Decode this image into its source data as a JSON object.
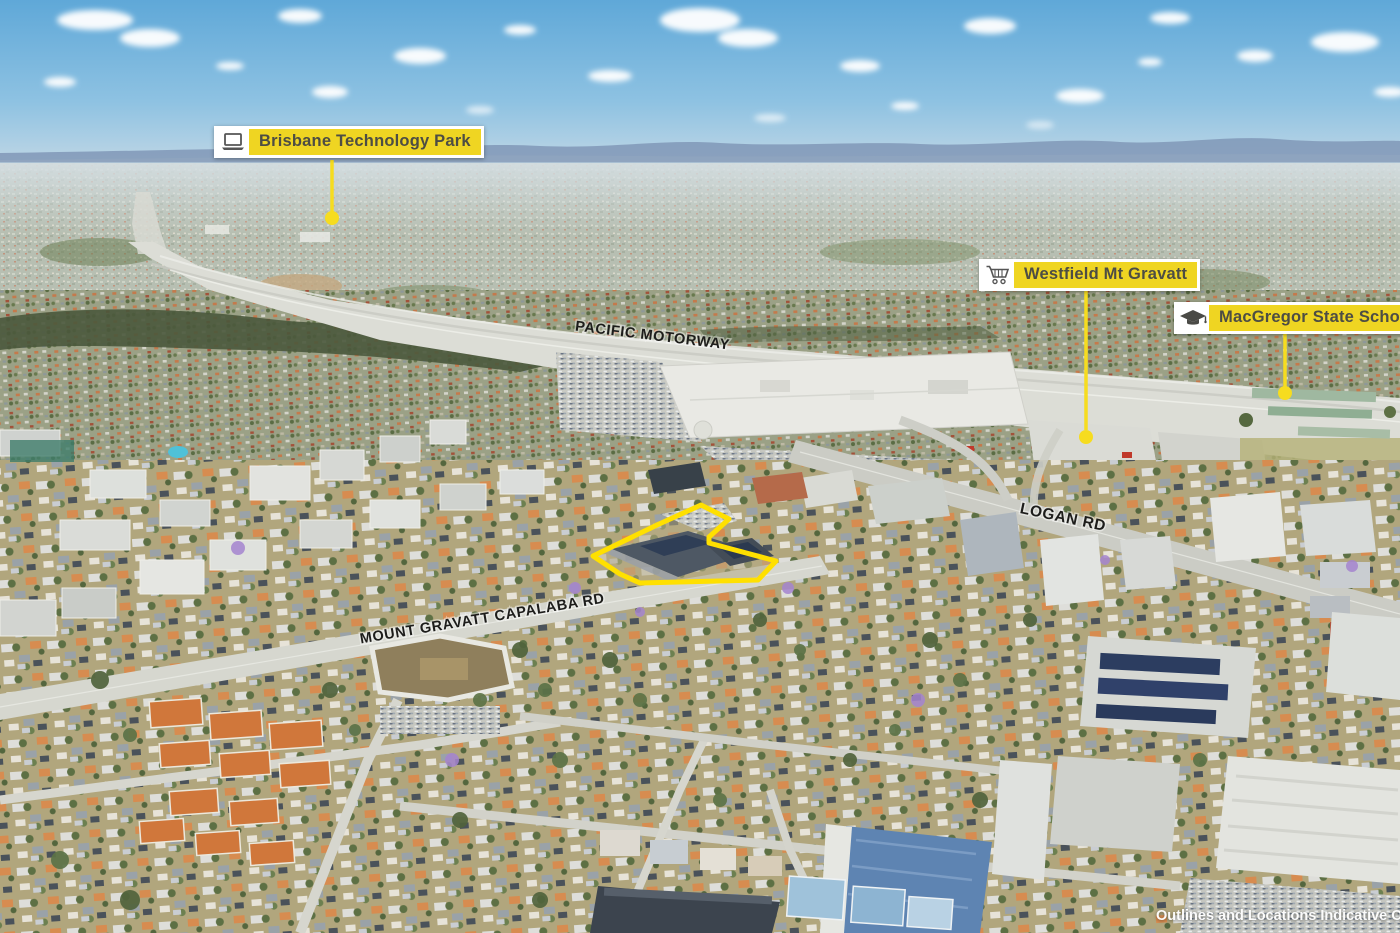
{
  "image_type": "annotated aerial photograph",
  "callouts": [
    {
      "label": "Brisbane Technology Park",
      "icon": "laptop-icon"
    },
    {
      "label": "Westfield Mt Gravatt",
      "icon": "shopping-cart-icon"
    },
    {
      "label": "MacGregor State School",
      "icon": "graduation-cap-icon"
    }
  ],
  "road_labels": [
    {
      "text": "PACIFIC MOTORWAY"
    },
    {
      "text": "LOGAN RD"
    },
    {
      "text": "MOUNT GRAVATT CAPALABA RD"
    }
  ],
  "disclaimer": "Outlines and Locations Indicative Only",
  "colors": {
    "label_background": "#EFD522",
    "label_card": "#FFFFFF",
    "label_text": "#4D4D44",
    "icon_gray": "#555555",
    "property_outline": "#FFE000",
    "leader_line": "#F6DC1F",
    "road_label_text": "#1D1D1B",
    "disclaimer_text": "#FFFFFF",
    "sky_top": "#5FA8D8",
    "sky_horizon": "#CFDDE6",
    "mountains": "#7D93B4"
  }
}
